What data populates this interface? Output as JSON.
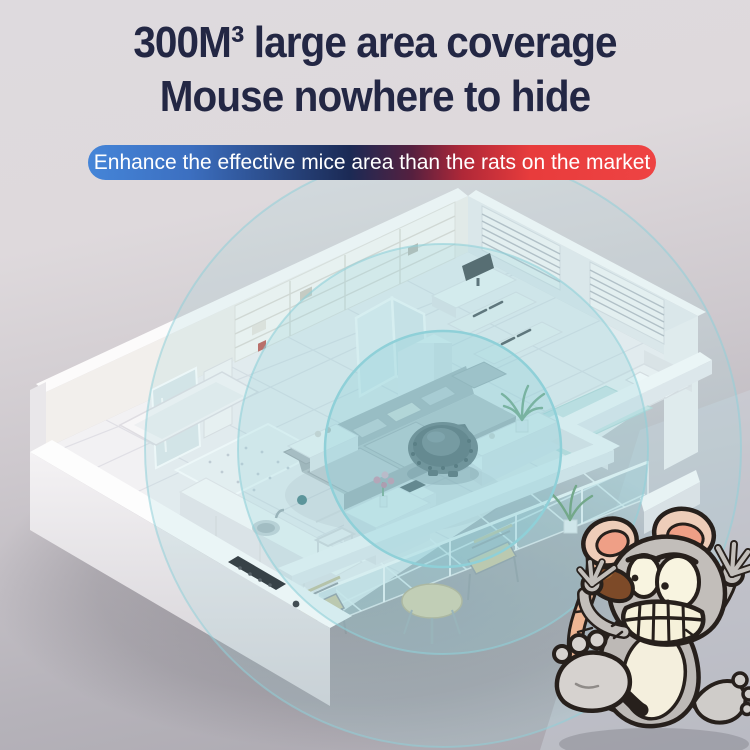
{
  "page": {
    "title_line1": "300M³ large area coverage",
    "title_line2": "Mouse nowhere to hide",
    "title_color": "#232744",
    "background_top": "#dedade",
    "background_bottom": "#a9a6ae"
  },
  "banner": {
    "text": "Enhance the effective mice area than the rats on the market",
    "text_color": "#ffffff",
    "gradient_left": "#4585d8",
    "gradient_mid": "#1b2a55",
    "gradient_right": "#e83c3c"
  },
  "scene": {
    "label": "Isometric apartment cutaway showing ultrasonic repeller coverage",
    "device_label": "ultrasonic-mouse-repeller",
    "coverage_rings": 3,
    "ring_color": "#8fd0d8",
    "rooms": [
      "bathroom",
      "shower",
      "kitchen",
      "living-room",
      "hallway",
      "wardrobe",
      "study",
      "bedroom",
      "dining-area",
      "balcony"
    ]
  },
  "mouse": {
    "label": "scared-cartoon-mouse-running-away",
    "body_color": "#bdb9b6",
    "belly_color": "#f4efdd",
    "ear_inner_color": "#ef9f86",
    "tail_color": "#eeb694",
    "nose_color": "#7d4a28",
    "outline_color": "#27201c"
  }
}
